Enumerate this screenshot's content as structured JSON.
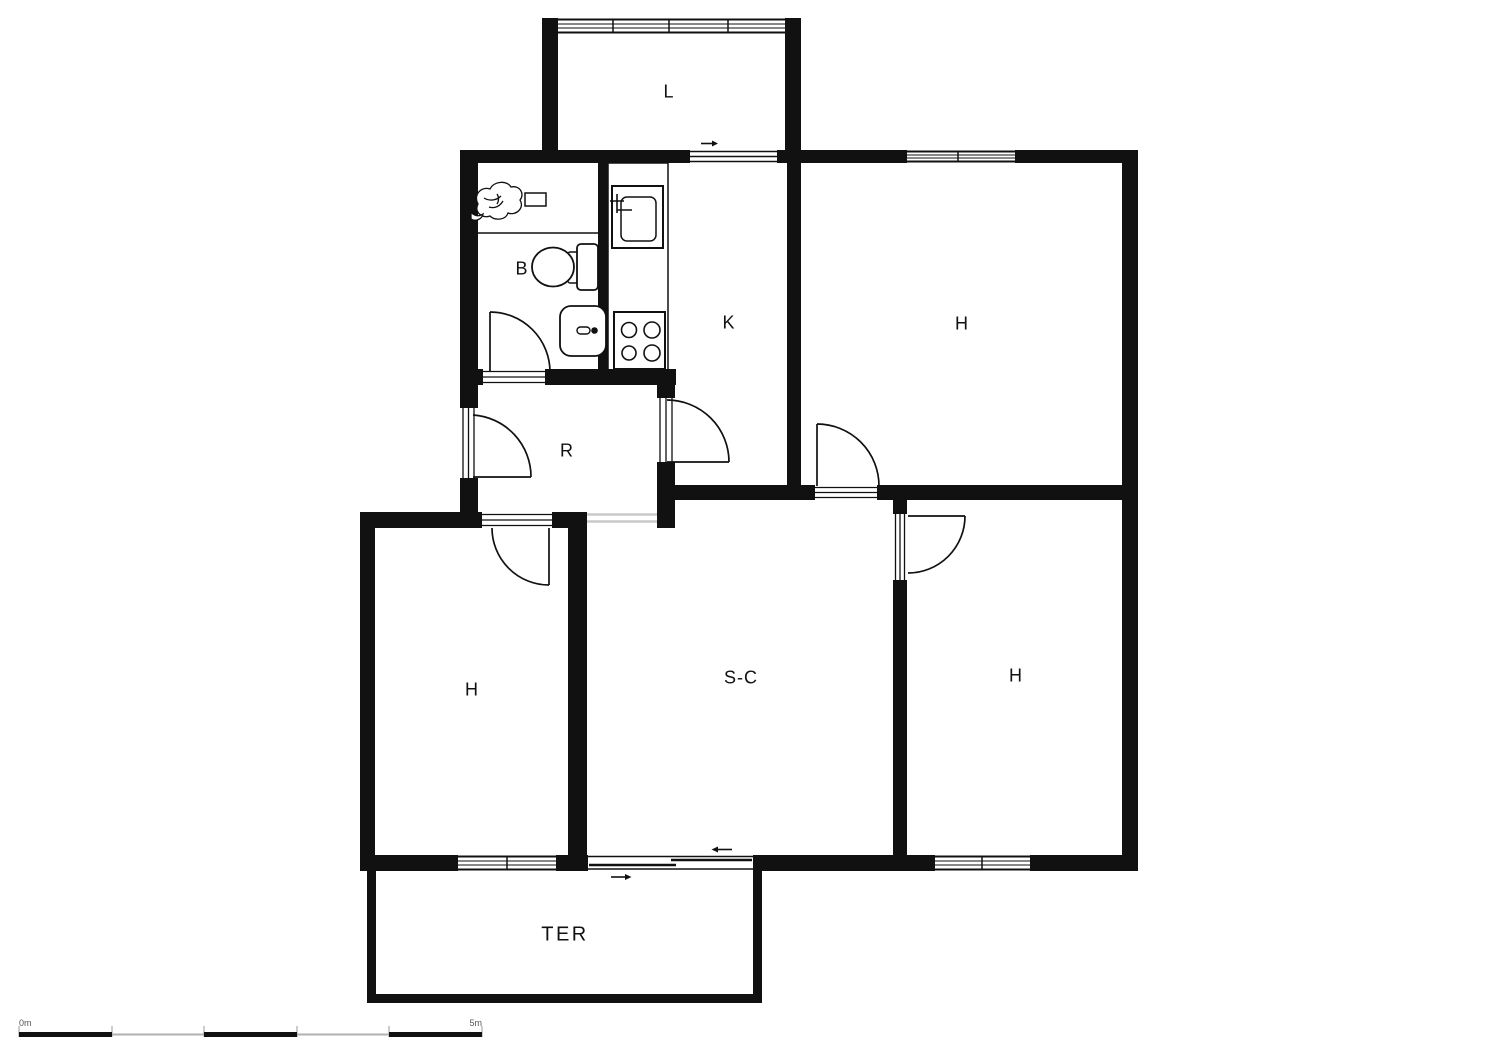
{
  "plan": {
    "type": "apartment-floor-plan",
    "rooms": [
      {
        "id": "loggia",
        "label": "L"
      },
      {
        "id": "bathroom",
        "label": "B"
      },
      {
        "id": "kitchen",
        "label": "K"
      },
      {
        "id": "bedroom-top-right",
        "label": "H"
      },
      {
        "id": "hall",
        "label": "R"
      },
      {
        "id": "bedroom-bottom-left",
        "label": "H"
      },
      {
        "id": "living-dining-room",
        "label": "S-C"
      },
      {
        "id": "bedroom-bottom-right",
        "label": "H"
      },
      {
        "id": "terrace",
        "label": "TER"
      }
    ],
    "fixtures": [
      "toilet",
      "washbasin",
      "plant",
      "shelf",
      "kitchen-sink",
      "stove-4-burners"
    ],
    "door_types": [
      "swing-door",
      "sliding-door",
      "open-passage"
    ],
    "scale_bar": {
      "start_label": "0m",
      "end_label": "5m"
    },
    "colors": {
      "wall": "#111111",
      "background": "#ffffff",
      "opening_marker": "#c9c9c9",
      "scale_gray": "#b0b0b0"
    }
  }
}
